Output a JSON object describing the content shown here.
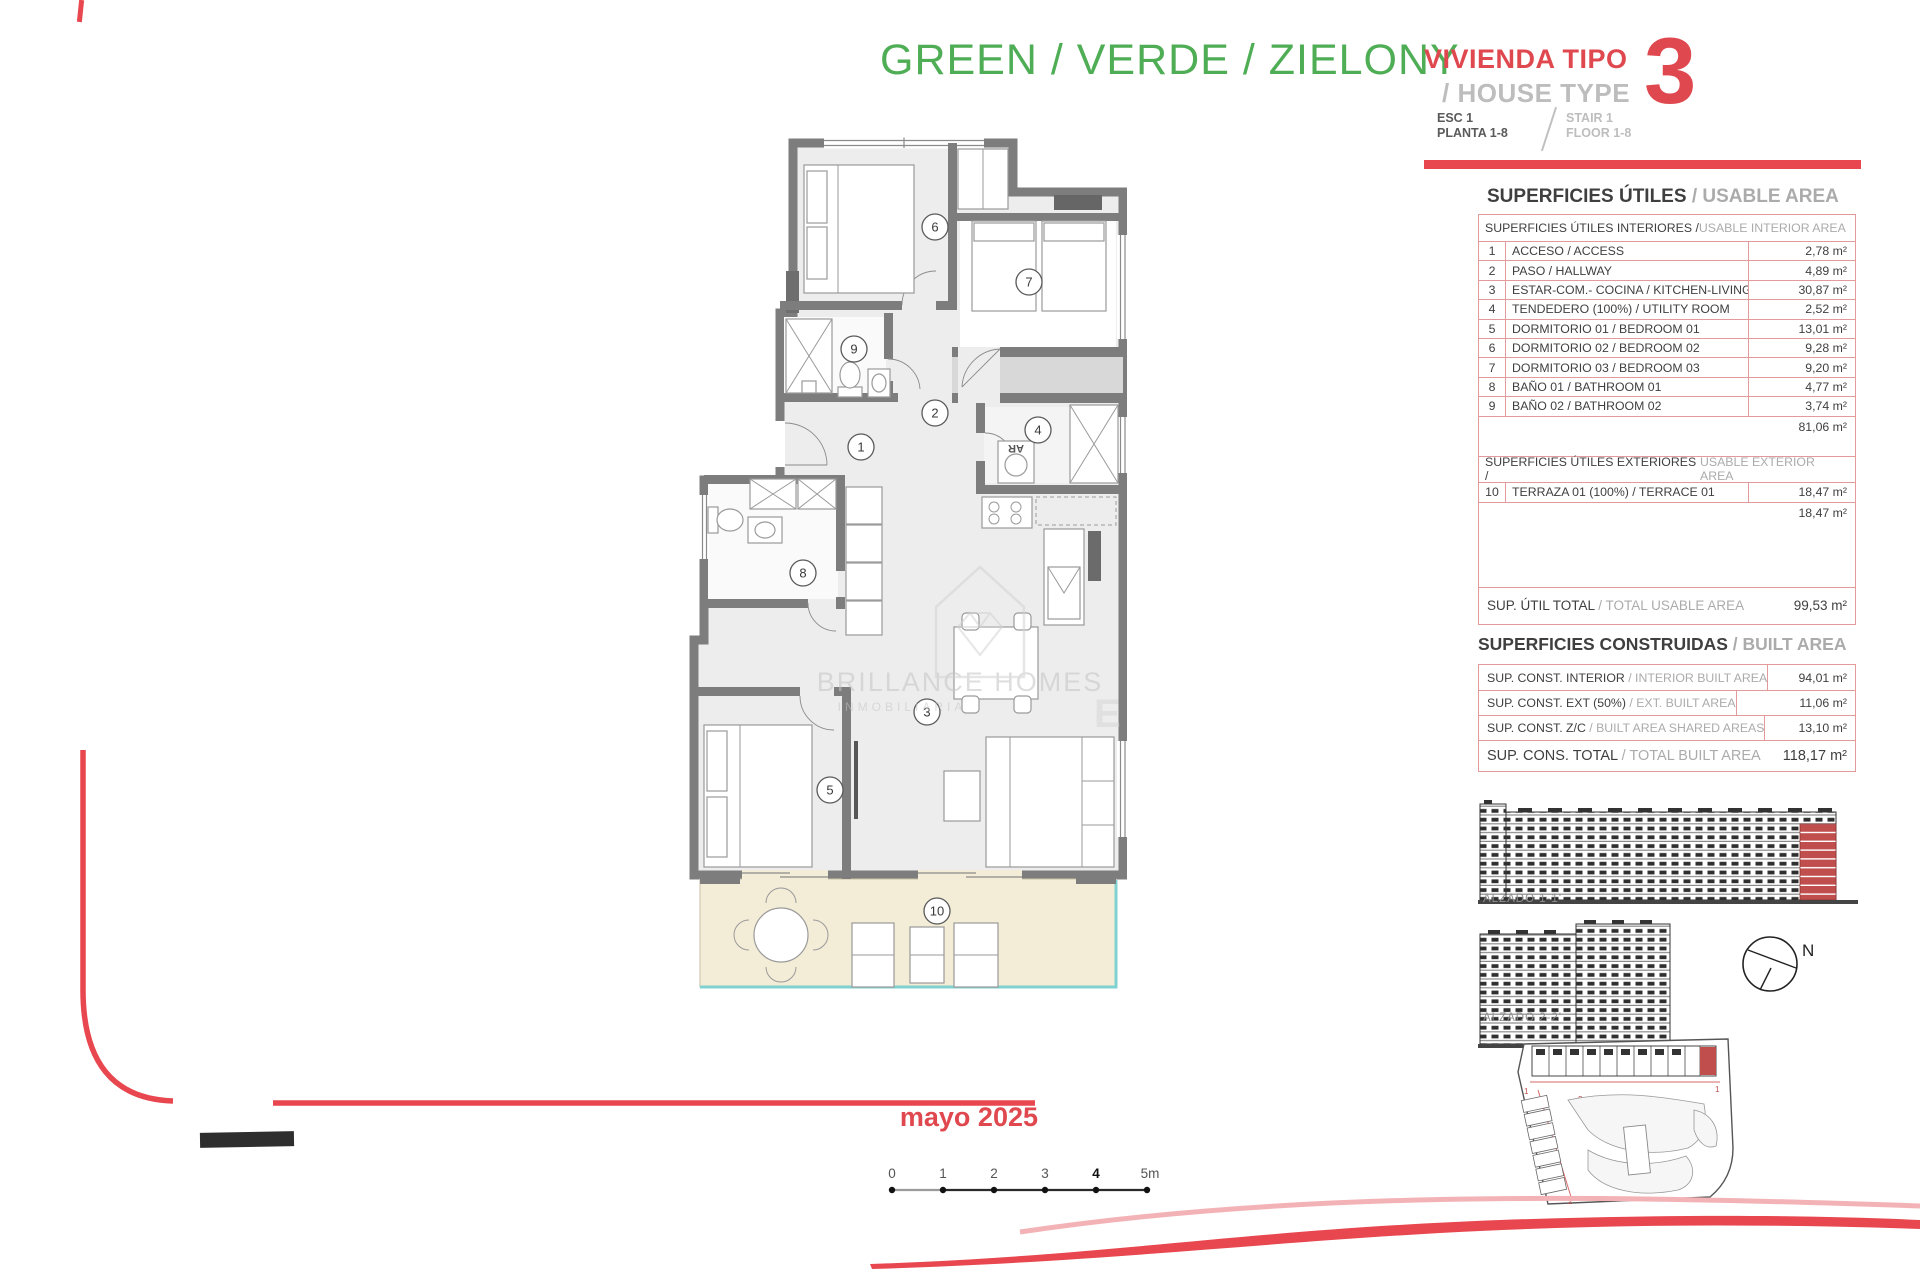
{
  "header": {
    "project_title": "GREEN / VERDE / ZIELONY",
    "house_type_es": "VIVIENDA TIPO",
    "house_type_en": "/ HOUSE TYPE",
    "house_type_number": "3",
    "esc_es": "ESC 1",
    "planta_es": "PLANTA 1-8",
    "stair_en": "STAIR 1",
    "floor_en": "FLOOR 1-8"
  },
  "usable": {
    "title_es": "SUPERFICIES ÚTILES",
    "title_en": "/ USABLE AREA",
    "interior_header_es": "SUPERFICIES ÚTILES INTERIORES /",
    "interior_header_en": " USABLE INTERIOR AREA",
    "interior_rows": [
      {
        "num": "1",
        "label": "ACCESO / ACCESS",
        "value": "2,78 m²"
      },
      {
        "num": "2",
        "label": "PASO / HALLWAY",
        "value": "4,89 m²"
      },
      {
        "num": "3",
        "label": "ESTAR-COM.- COCINA / KITCHEN-LIVING",
        "value": "30,87 m²"
      },
      {
        "num": "4",
        "label": "TENDEDERO (100%) / UTILITY ROOM",
        "value": "2,52 m²"
      },
      {
        "num": "5",
        "label": "DORMITORIO 01 / BEDROOM 01",
        "value": "13,01 m²"
      },
      {
        "num": "6",
        "label": "DORMITORIO 02 / BEDROOM 02",
        "value": "9,28 m²"
      },
      {
        "num": "7",
        "label": "DORMITORIO 03 / BEDROOM 03",
        "value": "9,20 m²"
      },
      {
        "num": "8",
        "label": "BAÑO 01 / BATHROOM 01",
        "value": "4,77 m²"
      },
      {
        "num": "9",
        "label": "BAÑO 02 / BATHROOM 02",
        "value": "3,74 m²"
      }
    ],
    "interior_subtotal": "81,06 m²",
    "exterior_header_es": "SUPERFICIES ÚTILES EXTERIORES /",
    "exterior_header_en": " USABLE EXTERIOR AREA",
    "exterior_rows": [
      {
        "num": "10",
        "label": "TERRAZA 01 (100%) / TERRACE 01",
        "value": "18,47 m²"
      }
    ],
    "exterior_subtotal": "18,47 m²",
    "total_label_es": "SUP. ÚTIL TOTAL ",
    "total_label_en": "/ TOTAL USABLE AREA",
    "total_value": "99,53 m²"
  },
  "built": {
    "title_es": "SUPERFICIES CONSTRUIDAS ",
    "title_en": "/ BUILT AREA",
    "rows": [
      {
        "label_es": "SUP. CONST. INTERIOR ",
        "label_en": "/ INTERIOR BUILT AREA",
        "value": "94,01 m²"
      },
      {
        "label_es": "SUP. CONST. EXT (50%) ",
        "label_en": "/ EXT. BUILT AREA",
        "value": "11,06 m²"
      },
      {
        "label_es": "SUP. CONST. Z/C ",
        "label_en": "/ BUILT AREA SHARED AREAS",
        "value": "13,10 m²"
      }
    ],
    "total_label_es": "SUP. CONS. TOTAL ",
    "total_label_en": "/ TOTAL BUILT AREA",
    "total_value": "118,17 m²"
  },
  "plan": {
    "rooms": [
      "1",
      "2",
      "3",
      "4",
      "5",
      "6",
      "7",
      "8",
      "9",
      "10"
    ],
    "washer_label": "AR"
  },
  "elevations": {
    "alzado1_label": "ALZADO 1-1'",
    "alzado2_label": "ALZADO 2-2'",
    "north_label": "N"
  },
  "site_plan": {
    "markers": [
      "1",
      "2"
    ]
  },
  "watermark": {
    "line1": "BRILLANCE HOMES",
    "line2": "INMOBILIARIA",
    "monogram": "E"
  },
  "footer": {
    "date": "mayo 2025",
    "scale_ticks": [
      "0",
      "1",
      "2",
      "3",
      "4",
      "5m"
    ]
  },
  "colors": {
    "brand_red": "#e8474f",
    "brand_green": "#4fae55",
    "table_border": "#e29a9b",
    "highlight_red": "#bf4e4c",
    "terrace_fill": "#f3ecd7",
    "railing_teal": "#7fd2d0"
  }
}
